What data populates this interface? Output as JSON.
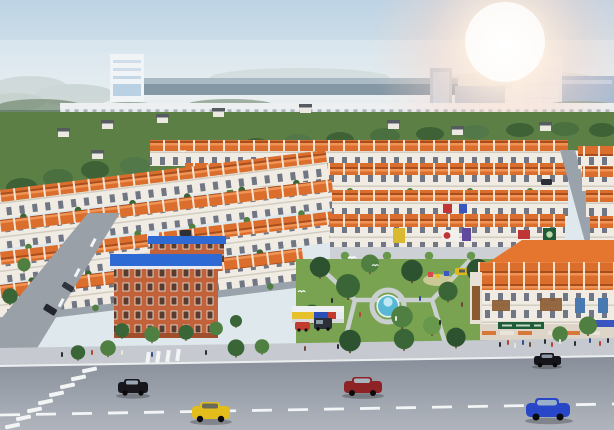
{
  "scene": {
    "description": "Aerial 3D architectural rendering of a planned township: parallel rows of terraced shophouses with terracotta roofs around a central landscaped park with a fountain, a brick school with blue metal roofs, a large corner commercial building, and a wide boulevard with cars in the foreground. Hazy industrial skyline with high-rise towers and a sun flare in the upper right.",
    "time_of_day": "hazy daylight, lens flare upper right"
  },
  "palette": {
    "sky_top": "#bdd3e4",
    "sky_mid": "#dde8ec",
    "sky_bottom": "#eff1ed",
    "roof_orange": "#dc6e2d",
    "roof_eave_highlight": "#f09455",
    "facade": "#f0ece3",
    "green_belt": "#5c7f46",
    "park_grass": "#79a350",
    "path_gray": "#cfd3d6",
    "road_top": "#878e99",
    "road_bottom": "#b0b5bd",
    "sidewalk": "#c6cad0",
    "school_brick": "#c2623a",
    "school_roof": "#2e6ad4",
    "villa_wall": "#ece9e2",
    "villa_roof": "#565b62",
    "water": "#56b8d4",
    "marking_white": "#f2f4f5"
  },
  "background": {
    "left_highrise": {
      "label": "white high-rise block"
    },
    "industrial_strip": {
      "label": "long factory / industrial park buildings"
    },
    "glass_tower": {
      "label": "tall glass tower under sun flare"
    },
    "commercial_strip": {
      "label": "low white commercial row on horizon"
    },
    "villas": {
      "label": "detached villas scattered in green belt",
      "count": 9
    }
  },
  "midground": {
    "townhouse_rows": {
      "label": "terraced shophouse rows with terracotta roofs",
      "row_count": 10
    },
    "school": {
      "label": "orange brick school with blue roofs"
    },
    "park": {
      "label": "central park",
      "features": [
        "fountain",
        "playground",
        "walking paths",
        "palm trees",
        "white doves"
      ]
    },
    "kiosk": {
      "label": "retail kiosk with striped fascia"
    },
    "corner_shophouse": {
      "label": "three-storey corner commercial building with curved tile roof"
    }
  },
  "signs": {
    "note": "shopfront signboards, lettering illegible at render resolution",
    "colors": [
      "#d8b92f",
      "#c03636",
      "#3b55c0",
      "#5f4a9e",
      "#1e5c38"
    ]
  },
  "kiosk": {
    "fascia_colors": [
      "#e6c12c",
      "#2a50b8",
      "#c23b2e"
    ]
  },
  "road": {
    "label": "main boulevard with dashed centerline and zebra crosswalk",
    "cars": [
      {
        "name": "black-sedan",
        "color": "#17171c"
      },
      {
        "name": "yellow-hatchback",
        "color": "#e3bd1c"
      },
      {
        "name": "maroon-sedan",
        "color": "#8e2326"
      },
      {
        "name": "blue-coupe",
        "color": "#2746c8"
      },
      {
        "name": "black-sedan-far",
        "color": "#141419"
      },
      {
        "name": "red-parked-car",
        "color": "#c23b2e"
      },
      {
        "name": "dark-van",
        "color": "#2b2f38"
      },
      {
        "name": "yellow-taxi",
        "color": "#e0b81e"
      }
    ]
  }
}
